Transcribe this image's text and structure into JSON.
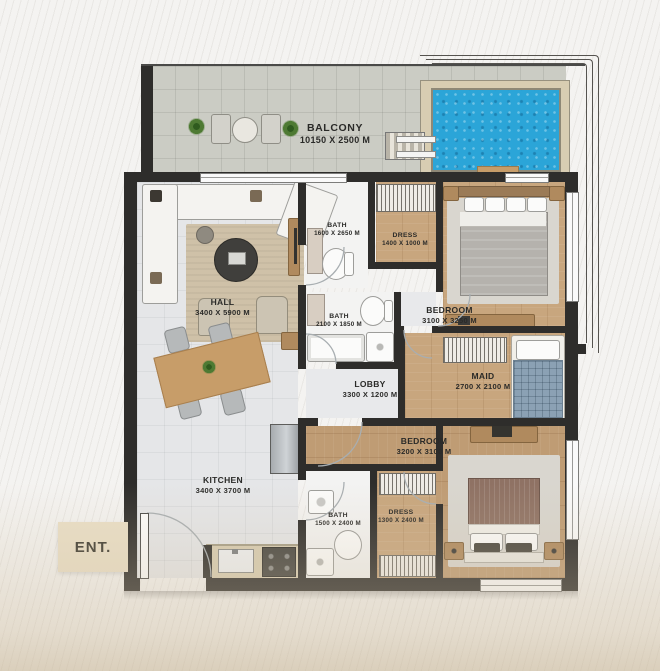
{
  "entrance": {
    "label": "ENT."
  },
  "rooms": [
    {
      "key": "balcony",
      "name": "BALCONY",
      "dims": "10150 X 2500 M"
    },
    {
      "key": "bath-top",
      "name": "BATH",
      "dims": "1600 X 2650 M"
    },
    {
      "key": "dress-top",
      "name": "DRESS",
      "dims": "1400 X 1000 M"
    },
    {
      "key": "bedroom-top",
      "name": "BEDROOM",
      "dims": "3100 X 3250 M"
    },
    {
      "key": "hall",
      "name": "HALL",
      "dims": "3400 X 5900 M"
    },
    {
      "key": "bath-middle",
      "name": "BATH",
      "dims": "2100 X 1850 M"
    },
    {
      "key": "lobby",
      "name": "LOBBY",
      "dims": "3300 X 1200 M"
    },
    {
      "key": "maid",
      "name": "MAID",
      "dims": "2700 X 2100 M"
    },
    {
      "key": "bedroom-bottom",
      "name": "BEDROOM",
      "dims": "3200 X 3100 M"
    },
    {
      "key": "kitchen",
      "name": "KITCHEN",
      "dims": "3400 X 3700 M"
    },
    {
      "key": "bath-bottom",
      "name": "BATH",
      "dims": "1500 X 2400 M"
    },
    {
      "key": "dress-bottom",
      "name": "DRESS",
      "dims": "1300 X 2400 M"
    }
  ],
  "colors": {
    "wall": "#2e2d2b",
    "pool_water": "#2ba5d8",
    "pool_deck": "#d8cdb2",
    "balcony_floor": "#cbccc4",
    "interior_floor": "#e5e6e8",
    "bath_floor": "#f3f3f2",
    "wood_light": "#c8a67e",
    "wood_dark": "#bf9c74",
    "rug_beige": "#cfc1a8",
    "rug_gray": "#d9d6cf",
    "sofa_white": "#f4f3f0",
    "furniture_wood": "#b08a5e",
    "table_wood": "#c79d69",
    "entrance_tag": "#eadfc7",
    "label_text": "#2a2a28"
  }
}
